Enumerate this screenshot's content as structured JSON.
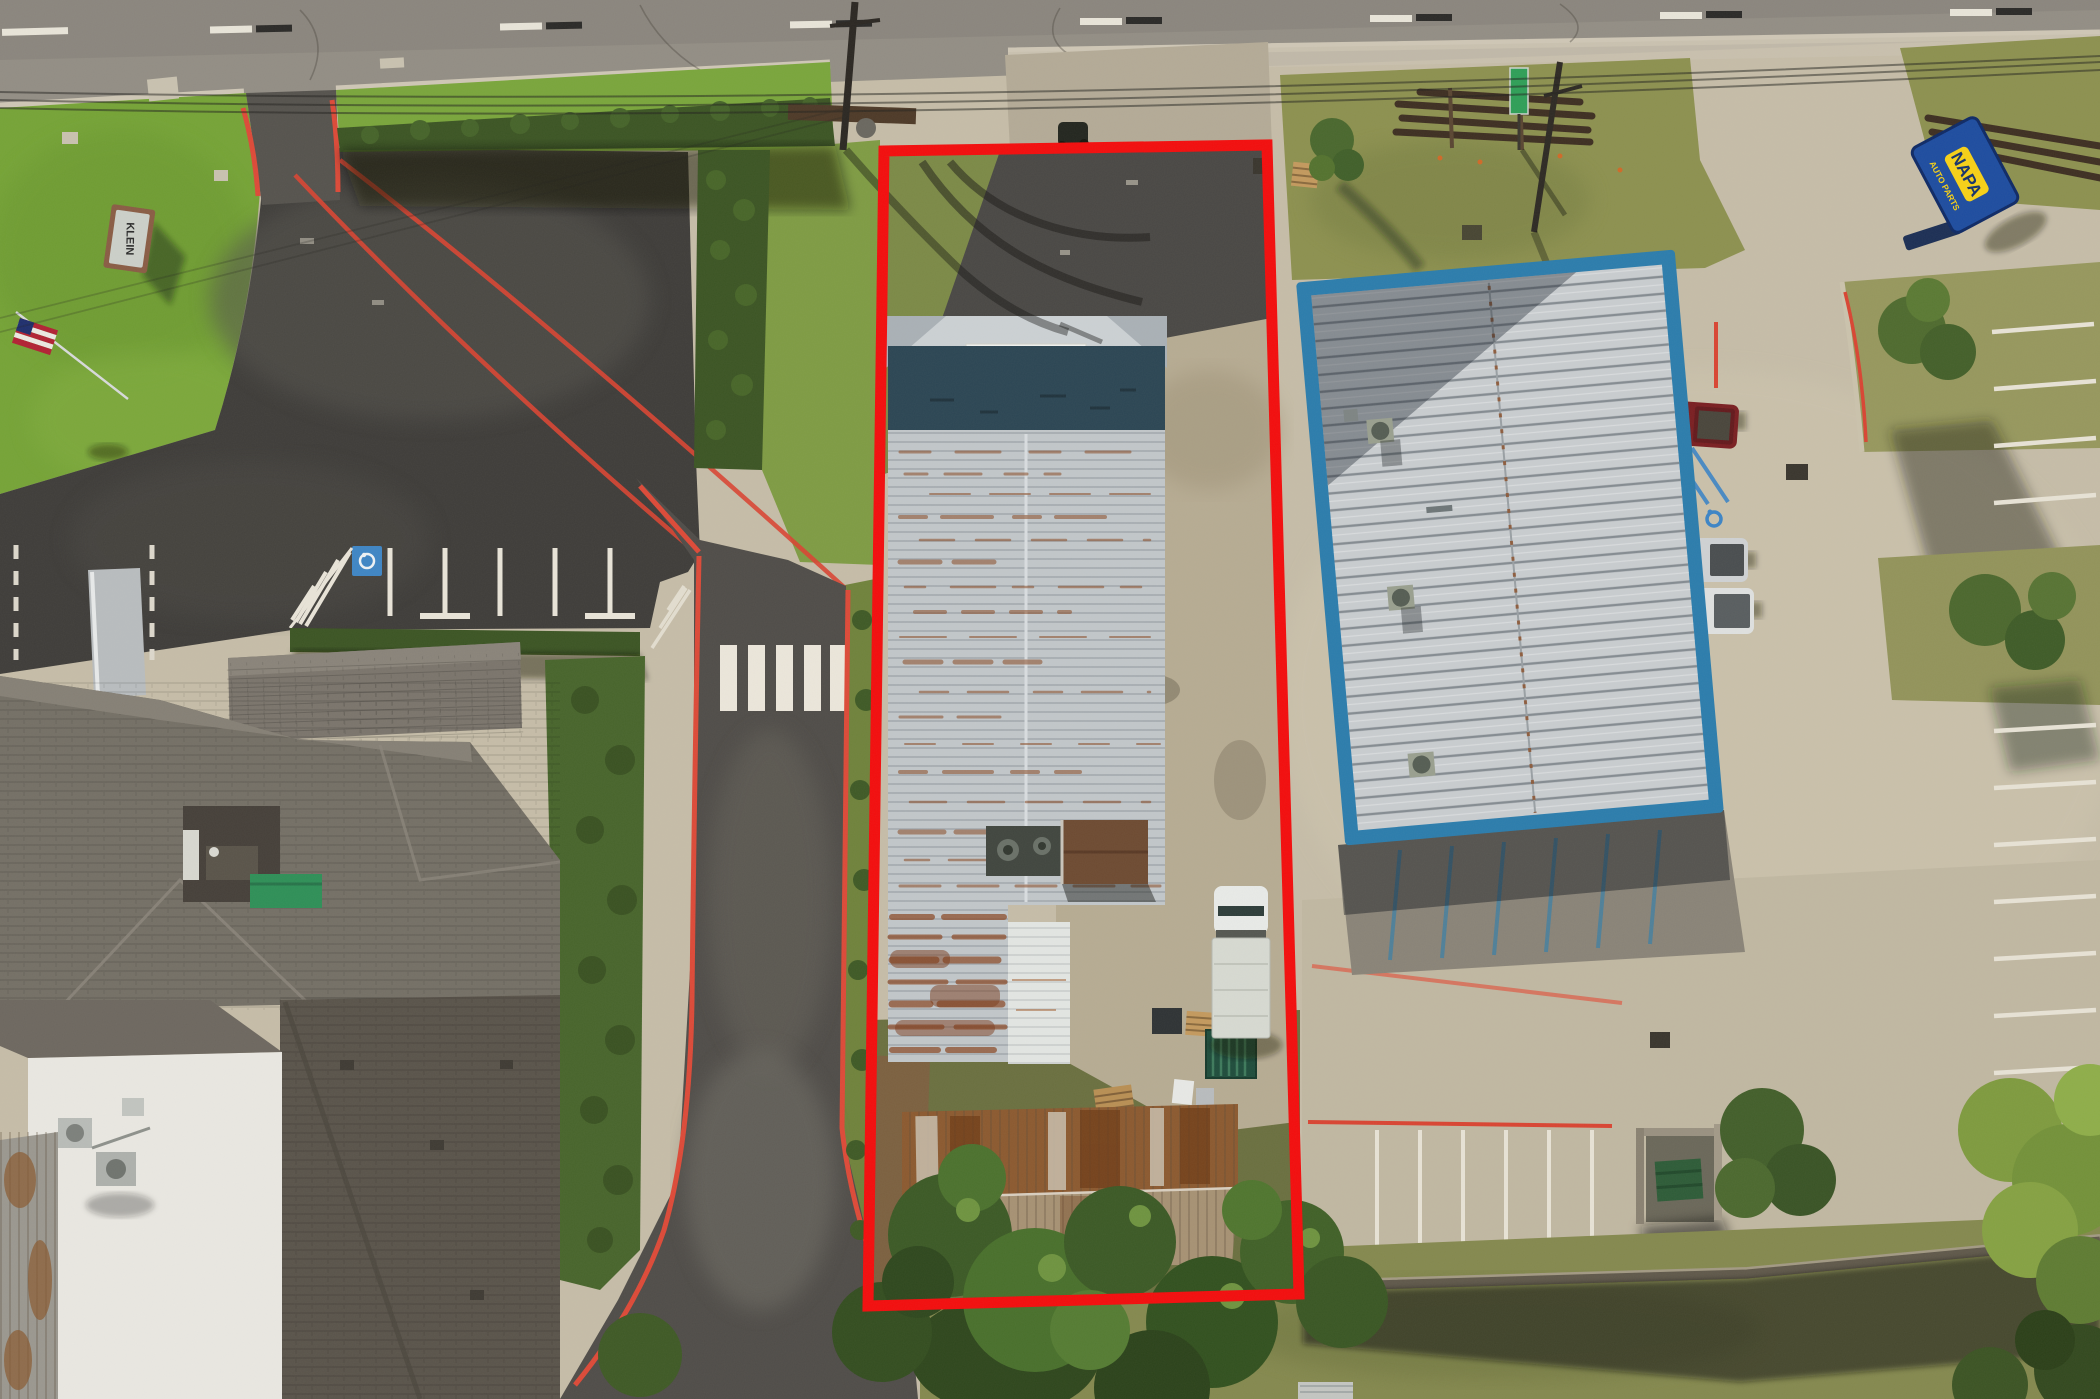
{
  "scene": {
    "type": "aerial-drone-photograph",
    "description": "Top-down aerial photo of a long narrow commercial parcel outlined in red, flanked by a funeral-home lawn and dark parking lot on the left and a NAPA Auto Parts store with a blue-trimmed metal roof on the right, fronting a two-lane road at the top.",
    "subject_property": {
      "outline_color": "#f30d0d",
      "outline_shape": "tall rectangle",
      "contents": "rusted white metal warehouse, concrete yard, box truck, rusty sheds, trees"
    }
  },
  "signs": {
    "napa_sign": {
      "line1": "NAPA",
      "line2": "AUTO PARTS",
      "panel_color": "#1e4da0",
      "logo_color": "#f7d117"
    },
    "monument_sign": {
      "text": "KLEIN",
      "face_color": "#ccd0c9",
      "frame_color": "#8a5d45"
    },
    "street_sign": {
      "color": "#2f9f58"
    }
  },
  "markings": {
    "crosswalk_bars": 5,
    "left_lot_stall_lines": 5,
    "right_lot_right_column_stalls": 11,
    "right_lot_bottom_row_stalls": 6,
    "handicap_symbols": 3,
    "fire_lane_curb_color": "#dd4a38",
    "stripe_color": "#ece7db"
  },
  "vehicles": {
    "box_truck": {
      "location": "subject yard",
      "cab_color": "#e9ebe8",
      "body_color": "#d7dad2"
    },
    "red_pickup": {
      "color": "#7a1f22"
    },
    "silver_pickup": {
      "color": "#cfd2d4"
    },
    "white_pickup": {
      "color": "#dfe1e0"
    },
    "maroon_suv": {
      "color": "#5c2023"
    }
  },
  "colors": {
    "road_gray": "#8f8a81",
    "asphalt_dark_lot": "#3e3c3a",
    "parcel_asphalt": "#4a4845",
    "concrete_light": "#c6bda8",
    "concrete_shaded": "#8a8478",
    "grass_bright": "#76a437",
    "grass_olive": "#8d9150",
    "metal_roof_light": "#c2c7ca",
    "roof_rust": "#8a4a24",
    "facade_shadow_slate": "#2c4654",
    "blue_building_trim": "#2c7dad",
    "blue_building_roof": "#c9cdd0",
    "shingle_gray": "#736d64",
    "flat_roof_white": "#eae8e2",
    "tree_green": "#42602a",
    "hedge_green": "#3c5524",
    "awning_green": "#2f9058",
    "carport_brown": "#6e4b32",
    "handicap_blue": "#3f86c5"
  }
}
